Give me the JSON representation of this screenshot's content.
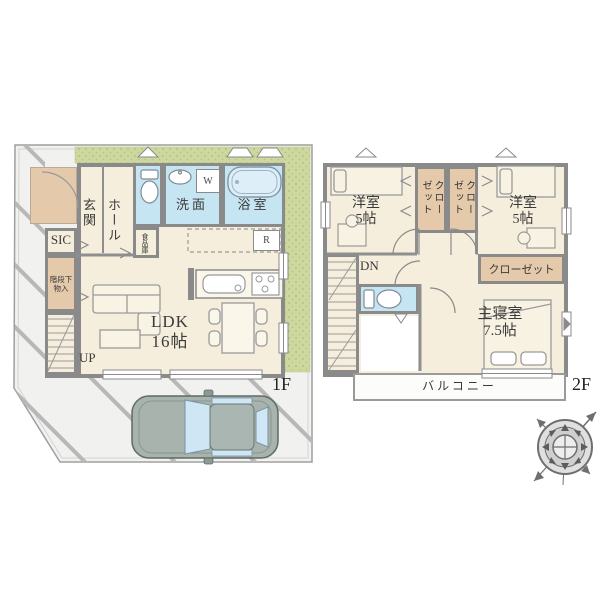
{
  "floor1": {
    "floor_label": "1F",
    "entrance": "玄関",
    "hall": "ホール",
    "sic": "SIC",
    "washroom": "洗面",
    "bathroom": "浴室",
    "pantry": "食品庫",
    "under_stair_line1": "階段下",
    "under_stair_line2": "物入",
    "ldk_line1": "LDK",
    "ldk_line2": "16帖",
    "stairs_up": "UP",
    "washer_mark": "W",
    "fridge_mark": "R"
  },
  "floor2": {
    "floor_label": "2F",
    "bedroom_left_line1": "洋室",
    "bedroom_left_line2": "5帖",
    "bedroom_right_line1": "洋室",
    "bedroom_right_line2": "5帖",
    "closet_left": "クローゼット",
    "closet_right": "クローゼット",
    "closet_master": "クローゼット",
    "stairs_down": "DN",
    "master_bedroom_line1": "主寝室",
    "master_bedroom_line2": "7.5帖",
    "balcony": "バルコニー"
  },
  "colors": {
    "floor": "#f6eedd",
    "tan": "#e5c9ab",
    "water": "#c6e5f3",
    "wall": "#8a8a8a",
    "garden": "#ccd89e",
    "site": "#f1f2ef"
  }
}
